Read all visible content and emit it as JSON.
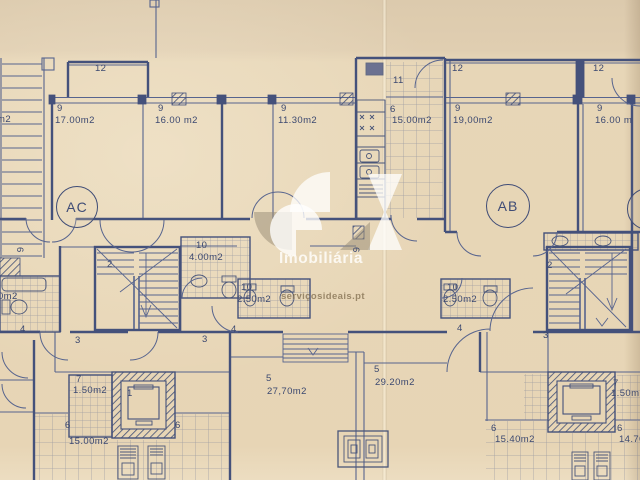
{
  "document": {
    "type": "scanned architectural floor plan",
    "units": "m2"
  },
  "colors": {
    "paper": "#e7d5b5",
    "ink": "#44517b",
    "tile": "#56638c",
    "watermark_text": "#fdfbf5"
  },
  "watermark": {
    "logo": "SI",
    "brand": "Imobiliária",
    "site": "serviçosideais.pt"
  },
  "unit_badges": [
    {
      "label": "AC"
    },
    {
      "label": "AB"
    },
    {
      "label": "A"
    }
  ],
  "plan_labels": [
    {
      "t": "12",
      "x": 95,
      "y": 64
    },
    {
      "t": "9",
      "x": 57,
      "y": 104
    },
    {
      "t": "17.00m2",
      "x": 55,
      "y": 116
    },
    {
      "t": "9",
      "x": 158,
      "y": 104
    },
    {
      "t": "16.00 m2",
      "x": 155,
      "y": 116
    },
    {
      "t": "9",
      "x": 281,
      "y": 104
    },
    {
      "t": "11.30m2",
      "x": 278,
      "y": 116
    },
    {
      "t": "11",
      "x": 393,
      "y": 76
    },
    {
      "t": "6",
      "x": 390,
      "y": 105
    },
    {
      "t": "15.00m2",
      "x": 392,
      "y": 116
    },
    {
      "t": "12",
      "x": 452,
      "y": 64
    },
    {
      "t": "9",
      "x": 455,
      "y": 104
    },
    {
      "t": "19,00m2",
      "x": 453,
      "y": 116
    },
    {
      "t": "12",
      "x": 593,
      "y": 64
    },
    {
      "t": "9",
      "x": 597,
      "y": 104
    },
    {
      "t": "16.00 m",
      "x": 595,
      "y": 116
    },
    {
      "t": "m2",
      "x": -3,
      "y": 115
    },
    {
      "t": "6",
      "x": 24,
      "y": 247,
      "rot": 90
    },
    {
      "t": "2",
      "x": 107,
      "y": 260
    },
    {
      "t": "10",
      "x": 196,
      "y": 241
    },
    {
      "t": "4.00m2",
      "x": 189,
      "y": 253
    },
    {
      "t": "0m2",
      "x": -2,
      "y": 292
    },
    {
      "t": "4",
      "x": 20,
      "y": 325
    },
    {
      "t": "10",
      "x": 241,
      "y": 283
    },
    {
      "t": "2.50m2",
      "x": 237,
      "y": 295
    },
    {
      "t": "6",
      "x": 360,
      "y": 247,
      "rot": 90
    },
    {
      "t": "4",
      "x": 231,
      "y": 325
    },
    {
      "t": "3",
      "x": 202,
      "y": 335
    },
    {
      "t": "10",
      "x": 447,
      "y": 283
    },
    {
      "t": "2.50m2",
      "x": 443,
      "y": 295
    },
    {
      "t": "4",
      "x": 457,
      "y": 324
    },
    {
      "t": "2",
      "x": 547,
      "y": 261
    },
    {
      "t": "3",
      "x": 543,
      "y": 331
    },
    {
      "t": "3",
      "x": 75,
      "y": 336
    },
    {
      "t": "7",
      "x": 76,
      "y": 375
    },
    {
      "t": "1.50m2",
      "x": 73,
      "y": 386
    },
    {
      "t": "1",
      "x": 127,
      "y": 389
    },
    {
      "t": "6",
      "x": 65,
      "y": 421
    },
    {
      "t": "15.00m2",
      "x": 69,
      "y": 437
    },
    {
      "t": "6",
      "x": 175,
      "y": 421
    },
    {
      "t": "5",
      "x": 266,
      "y": 374
    },
    {
      "t": "27,70m2",
      "x": 267,
      "y": 387
    },
    {
      "t": "5",
      "x": 374,
      "y": 365
    },
    {
      "t": "29.20m2",
      "x": 375,
      "y": 378
    },
    {
      "t": "6",
      "x": 491,
      "y": 424
    },
    {
      "t": "15.40m2",
      "x": 495,
      "y": 435
    },
    {
      "t": "7",
      "x": 613,
      "y": 379
    },
    {
      "t": "1.50m",
      "x": 611,
      "y": 389
    },
    {
      "t": "6",
      "x": 617,
      "y": 424
    },
    {
      "t": "14.70",
      "x": 619,
      "y": 435
    }
  ]
}
